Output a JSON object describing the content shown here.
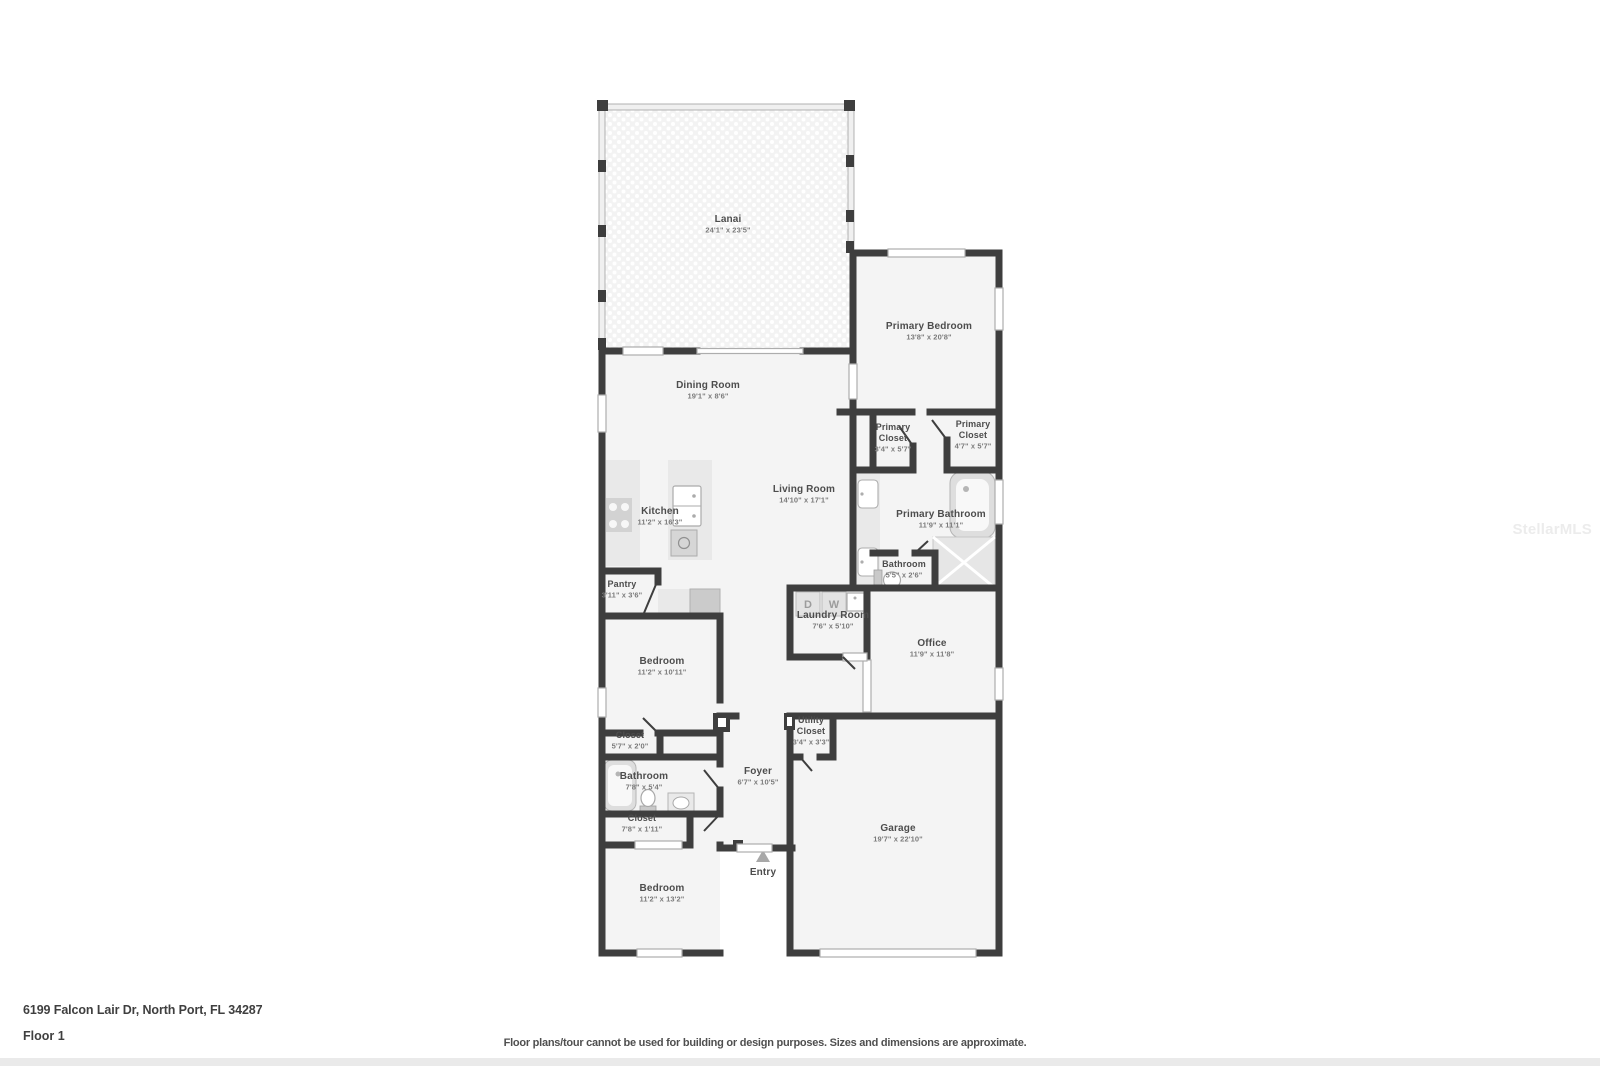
{
  "footer": {
    "address": "6199 Falcon Lair Dr, North Port, FL 34287",
    "floor_label": "Floor 1",
    "disclaimer": "Floor plans/tour cannot be used for building or design purposes. Sizes and dimensions are approximate."
  },
  "watermark": {
    "text": "StellarMLS"
  },
  "colors": {
    "wall": "#3e3e3e",
    "room_fill": "#f4f4f4",
    "lanai_fill": "#f3f3f3",
    "fixture_fill": "#e9e9e9",
    "fixture_dark": "#cbcbcb",
    "label_text": "#4d4d4d",
    "dims_text": "#7a7a7a",
    "footer_bar": "#eaeaea"
  },
  "rooms": [
    {
      "id": "lanai",
      "name": "Lanai",
      "dims": "24'1\" x 23'5\"",
      "x": 728,
      "y": 222
    },
    {
      "id": "dining-room",
      "name": "Dining Room",
      "dims": "19'1\" x 8'6\"",
      "x": 708,
      "y": 388
    },
    {
      "id": "primary-bedroom",
      "name": "Primary Bedroom",
      "dims": "13'8\" x 20'8\"",
      "x": 929,
      "y": 329
    },
    {
      "id": "primary-closet-left",
      "name": "Primary",
      "name2": "Closet",
      "dims": "3'4\" x 5'7\"",
      "x": 893,
      "y": 430,
      "small": true
    },
    {
      "id": "primary-closet-right",
      "name": "Primary",
      "name2": "Closet",
      "dims": "4'7\" x 5'7\"",
      "x": 973,
      "y": 427,
      "small": true
    },
    {
      "id": "living-room",
      "name": "Living Room",
      "dims": "14'10\" x 17'1\"",
      "x": 804,
      "y": 492
    },
    {
      "id": "kitchen",
      "name": "Kitchen",
      "dims": "11'2\" x 16'3\"",
      "x": 660,
      "y": 514
    },
    {
      "id": "primary-bathroom",
      "name": "Primary Bathroom",
      "dims": "11'9\" x 11'1\"",
      "x": 941,
      "y": 517
    },
    {
      "id": "bathroom-wc",
      "name": "Bathroom",
      "dims": "5'5\" x 2'6\"",
      "x": 904,
      "y": 567,
      "small": true
    },
    {
      "id": "pantry",
      "name": "Pantry",
      "dims": "3'11\" x 3'6\"",
      "x": 622,
      "y": 587,
      "small": true
    },
    {
      "id": "laundry-room",
      "name": "Laundry Room",
      "dims": "7'6\" x 5'10\"",
      "x": 833,
      "y": 618
    },
    {
      "id": "office",
      "name": "Office",
      "dims": "11'9\" x 11'8\"",
      "x": 932,
      "y": 646
    },
    {
      "id": "bedroom-1",
      "name": "Bedroom",
      "dims": "11'2\" x 10'11\"",
      "x": 662,
      "y": 664
    },
    {
      "id": "closet-1",
      "name": "Closet",
      "dims": "5'7\" x 2'0\"",
      "x": 630,
      "y": 738,
      "small": true
    },
    {
      "id": "utility-closet",
      "name": "Utility",
      "name2": "Closet",
      "dims": "3'4\" x 3'3\"",
      "x": 811,
      "y": 723,
      "small": true
    },
    {
      "id": "bathroom-2",
      "name": "Bathroom",
      "dims": "7'8\" x 5'4\"",
      "x": 644,
      "y": 779
    },
    {
      "id": "foyer",
      "name": "Foyer",
      "dims": "6'7\" x 10'5\"",
      "x": 758,
      "y": 774
    },
    {
      "id": "closet-2",
      "name": "Closet",
      "dims": "7'8\" x 1'11\"",
      "x": 642,
      "y": 821,
      "small": true
    },
    {
      "id": "garage",
      "name": "Garage",
      "dims": "19'7\" x 22'10\"",
      "x": 898,
      "y": 831
    },
    {
      "id": "entry",
      "name": "Entry",
      "dims": null,
      "x": 763,
      "y": 875
    },
    {
      "id": "bedroom-2",
      "name": "Bedroom",
      "dims": "11'2\" x 13'2\"",
      "x": 662,
      "y": 891
    }
  ],
  "laundry_appliances": [
    {
      "id": "dryer",
      "label": "D",
      "x": 808,
      "y": 608
    },
    {
      "id": "washer",
      "label": "W",
      "x": 834,
      "y": 608
    }
  ]
}
